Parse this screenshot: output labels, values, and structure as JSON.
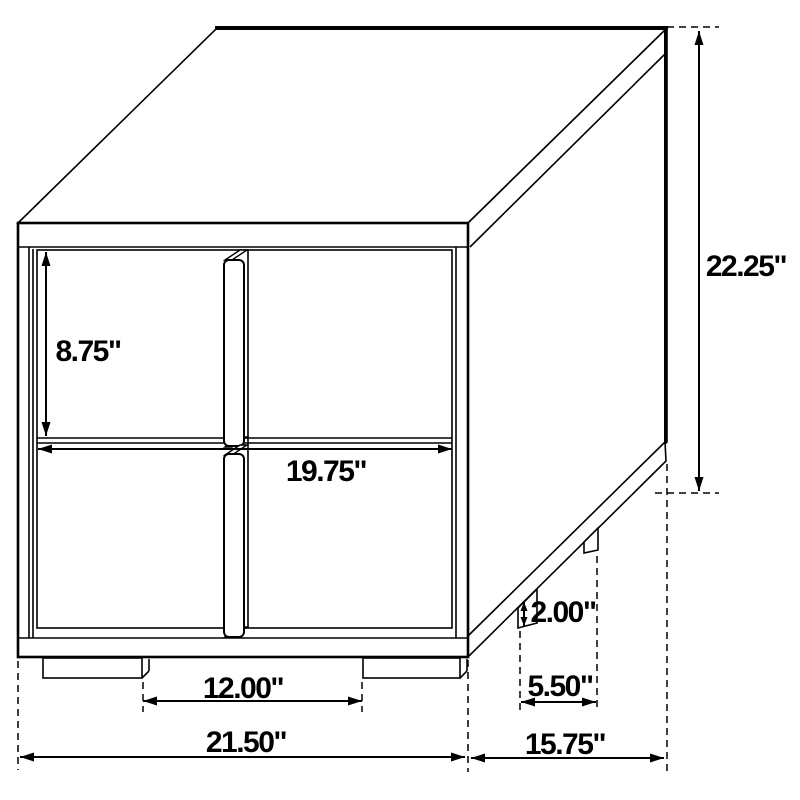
{
  "diagram": {
    "subject": "nightstand-dimension-drawing",
    "colors": {
      "line_color": "#000000",
      "background_color": "#ffffff"
    },
    "dimensions": {
      "drawer_height": "8.75\"",
      "overall_height": "22.25\"",
      "drawer_width": "19.75\"",
      "front_foot_spacing": "12.00\"",
      "overall_width": "21.50\"",
      "base_height": "2.00\"",
      "side_foot_spacing": "5.50\"",
      "overall_depth": "15.75\""
    }
  }
}
